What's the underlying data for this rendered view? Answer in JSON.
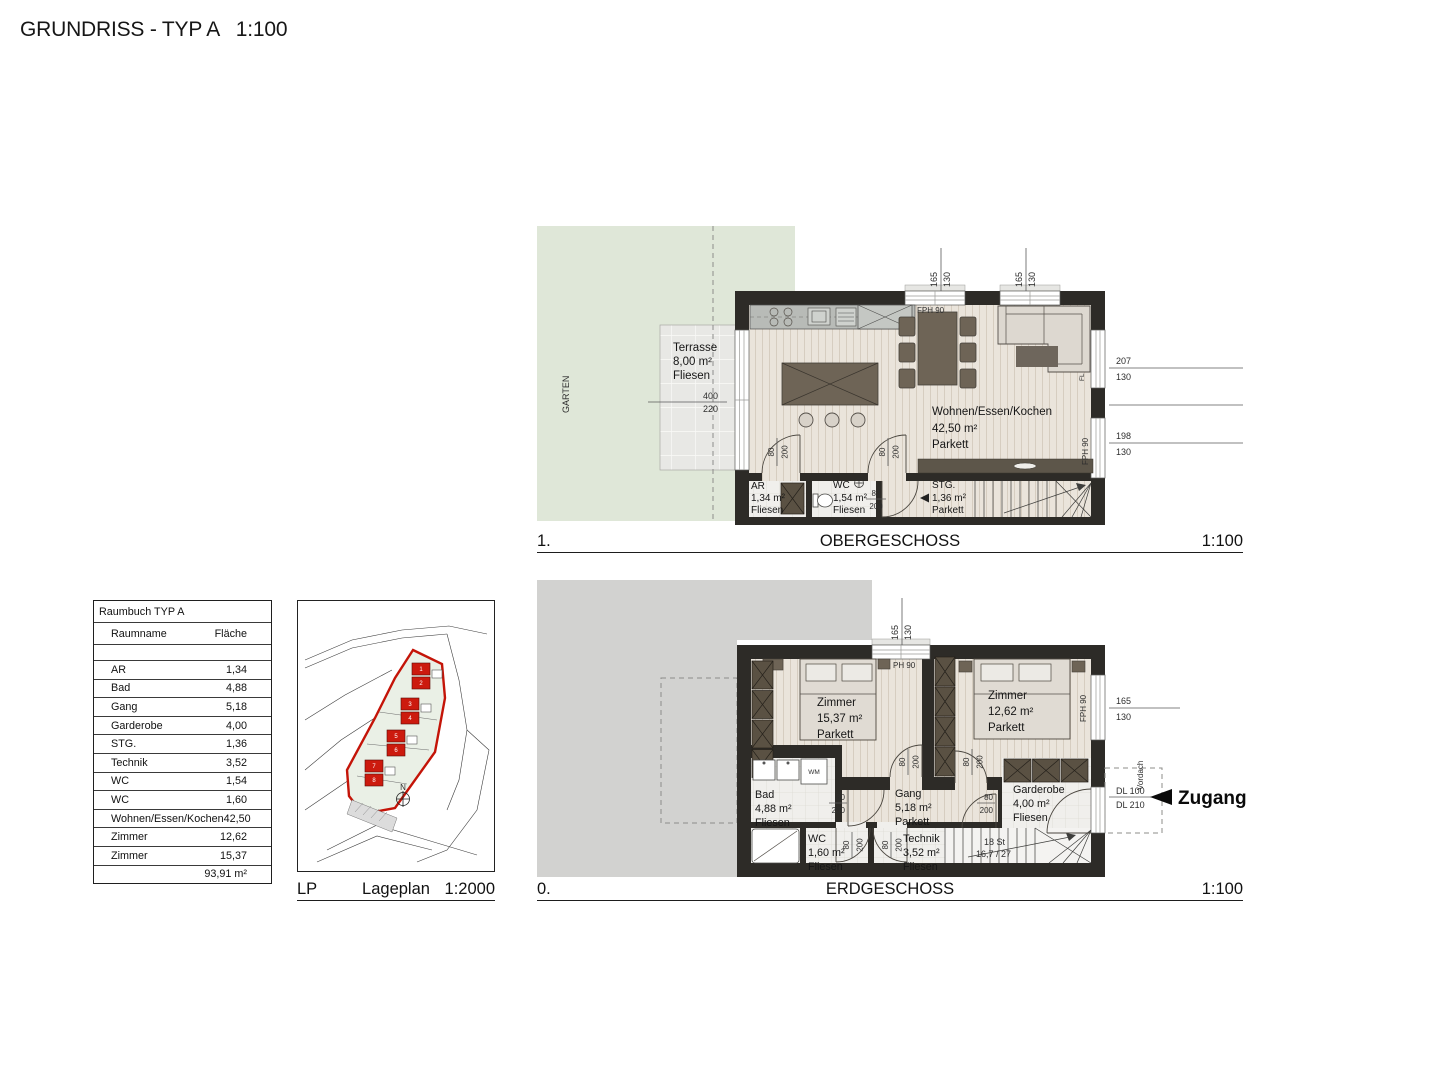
{
  "title": "GRUNDRISS - TYP A   1:100",
  "captions": {
    "og": {
      "index": "1.",
      "name": "OBERGESCHOSS",
      "scale": "1:100"
    },
    "eg": {
      "index": "0.",
      "name": "ERDGESCHOSS",
      "scale": "1:100"
    },
    "lp": {
      "index": "LP",
      "name": "Lageplan",
      "scale": "1:2000"
    }
  },
  "room_table": {
    "title": "Raumbuch TYP A",
    "columns": {
      "room": "Raumname",
      "area": "Fläche"
    },
    "rows": [
      {
        "room": "AR",
        "area": "1,34"
      },
      {
        "room": "Bad",
        "area": "4,88"
      },
      {
        "room": "Gang",
        "area": "5,18"
      },
      {
        "room": "Garderobe",
        "area": "4,00"
      },
      {
        "room": "STG.",
        "area": "1,36"
      },
      {
        "room": "Technik",
        "area": "3,52"
      },
      {
        "room": "WC",
        "area": "1,54"
      },
      {
        "room": "WC",
        "area": "1,60"
      },
      {
        "room": "Wohnen/Essen/Kochen",
        "area": "42,50"
      },
      {
        "room": "Zimmer",
        "area": "12,62"
      },
      {
        "room": "Zimmer",
        "area": "15,37"
      }
    ],
    "total": "93,91 m²"
  },
  "site_plan": {
    "north": "N",
    "buildings": [
      "1",
      "2",
      "3",
      "4",
      "5",
      "6",
      "7",
      "8"
    ]
  },
  "og": {
    "garden": "GARTEN",
    "terrace": {
      "name": "Terrasse",
      "area": "8,00 m²",
      "floor": "Fliesen"
    },
    "terrace_dim": {
      "a": "400",
      "b": "220"
    },
    "wohnen": {
      "name": "Wohnen/Essen/Kochen",
      "area": "42,50 m²",
      "floor": "Parkett"
    },
    "ar": {
      "name": "AR",
      "area": "1,34 m²",
      "floor": "Fliesen"
    },
    "wc": {
      "name": "WC",
      "area": "1,54 m²",
      "floor": "Fliesen"
    },
    "stg": {
      "name": "STG.",
      "area": "1,36 m²",
      "floor": "Parkett"
    },
    "win_top": {
      "a": "165",
      "b": "130"
    },
    "win_right1": {
      "a": "207",
      "b": "130"
    },
    "win_right2": {
      "a": "198",
      "b": "130"
    },
    "door_dim": {
      "a": "80",
      "b": "200"
    },
    "fph_top": "FPH 90",
    "fph_right": "FPH 90",
    "fl": "FL"
  },
  "eg": {
    "zimmer1": {
      "name": "Zimmer",
      "area": "15,37 m²",
      "floor": "Parkett"
    },
    "zimmer2": {
      "name": "Zimmer",
      "area": "12,62 m²",
      "floor": "Parkett"
    },
    "bad": {
      "name": "Bad",
      "area": "4,88 m²",
      "floor": "Fliesen"
    },
    "wc": {
      "name": "WC",
      "area": "1,60 m²",
      "floor": "Fliesen"
    },
    "gang": {
      "name": "Gang",
      "area": "5,18 m²",
      "floor": "Parkett"
    },
    "technik": {
      "name": "Technik",
      "area": "3,52 m²",
      "floor": "Fliesen"
    },
    "garderobe": {
      "name": "Garderobe",
      "area": "4,00 m²",
      "floor": "Fliesen"
    },
    "stair": {
      "steps": "18 St",
      "ratio": "16,7 / 27"
    },
    "win_top": {
      "a": "165",
      "b": "130"
    },
    "win_right": {
      "a": "165",
      "b": "130"
    },
    "door_dim": {
      "a": "80",
      "b": "200"
    },
    "entry": {
      "zugang": "Zugang",
      "dl_a": "DL 100",
      "dl_b": "DL 210",
      "vordach": "Vordach"
    },
    "ph90": "PH 90",
    "fph_right": "FPH 90",
    "wm": "WM"
  }
}
